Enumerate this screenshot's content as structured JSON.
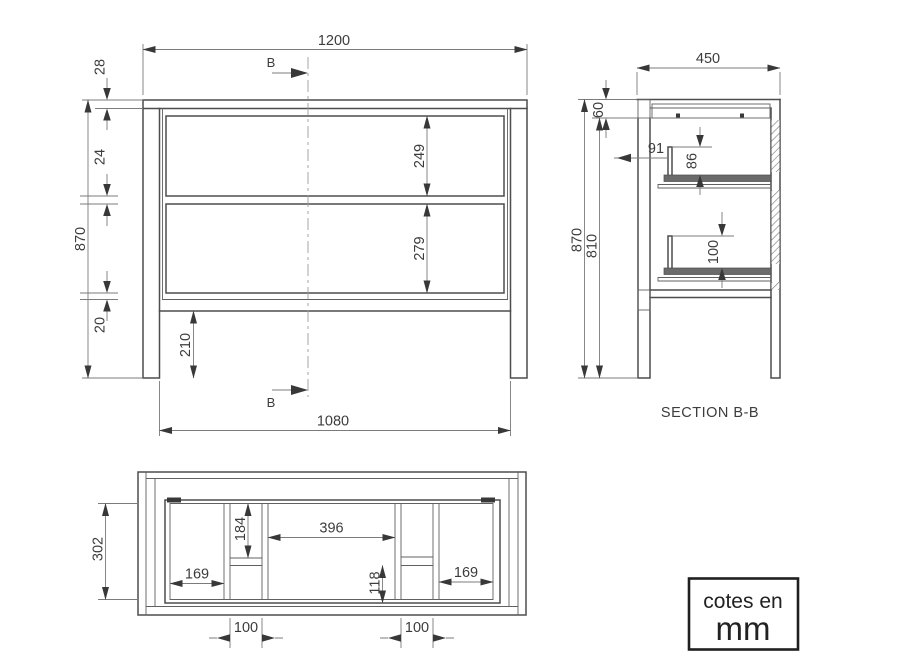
{
  "drawing": {
    "units_box": {
      "line1": "cotes en",
      "line2": "mm"
    },
    "front_view": {
      "section_marker_top": "B",
      "section_marker_bottom": "B",
      "dims": {
        "width_top": "1200",
        "top_thickness": "28",
        "drawer_gap": "24",
        "height_total": "870",
        "bottom_rail": "20",
        "drawer1_height": "249",
        "drawer2_height": "279",
        "leg_clearance": "210",
        "width_bottom": "1080"
      }
    },
    "section_view": {
      "title": "SECTION B-B",
      "dims": {
        "depth": "450",
        "top_assembly": "60",
        "height_total": "870",
        "height_under_top": "810",
        "drawer_setback": "91",
        "upper_slide_height": "86",
        "lower_slide_height": "100"
      }
    },
    "plan_view": {
      "dims": {
        "body_depth": "302",
        "back_offset": "184",
        "left_compartment": "169",
        "center_width": "396",
        "front_offset": "118",
        "right_compartment": "169",
        "left_channel": "100",
        "right_channel": "100"
      }
    }
  }
}
